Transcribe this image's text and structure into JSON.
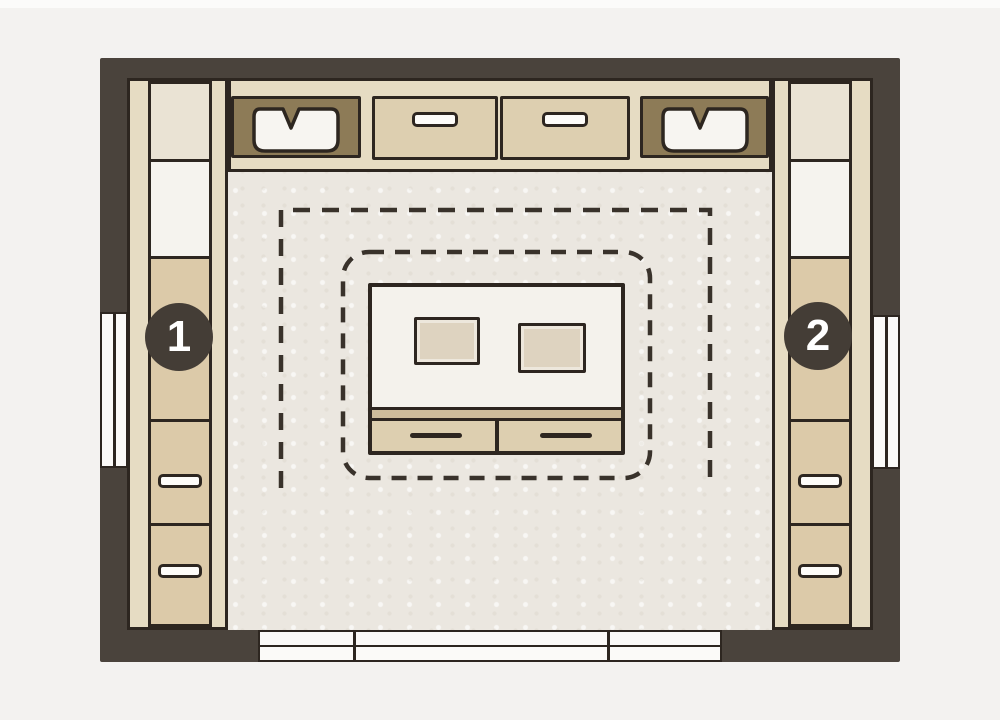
{
  "diagram": {
    "kind": "walk-in-closet-floor-plan",
    "markers": {
      "left": {
        "label": "1"
      },
      "right": {
        "label": "2"
      }
    }
  },
  "colors": {
    "bg": "#f3f2f0",
    "topStrip": "#fbfbfa",
    "wall": "#4a433c",
    "outline": "#2d2620",
    "floor": "#ebe7e0",
    "frame": "#e6dcc3",
    "panelTan": "#dccaa9",
    "panelWhite": "#f5f3ee",
    "panelBeige": "#eae3d4",
    "cabinetDark": "#8d7b57",
    "drawerFace": "#ddcfb0",
    "handleFill": "#fdfcf9",
    "islandWhite": "#f4f2ec",
    "islandShelf": "#cdbc9b",
    "cushion": "#ded3c0",
    "markerBg": "#443d36",
    "markerText": "#ffffff",
    "dash": "#39322b",
    "doorFill": "#fbfaf8"
  }
}
